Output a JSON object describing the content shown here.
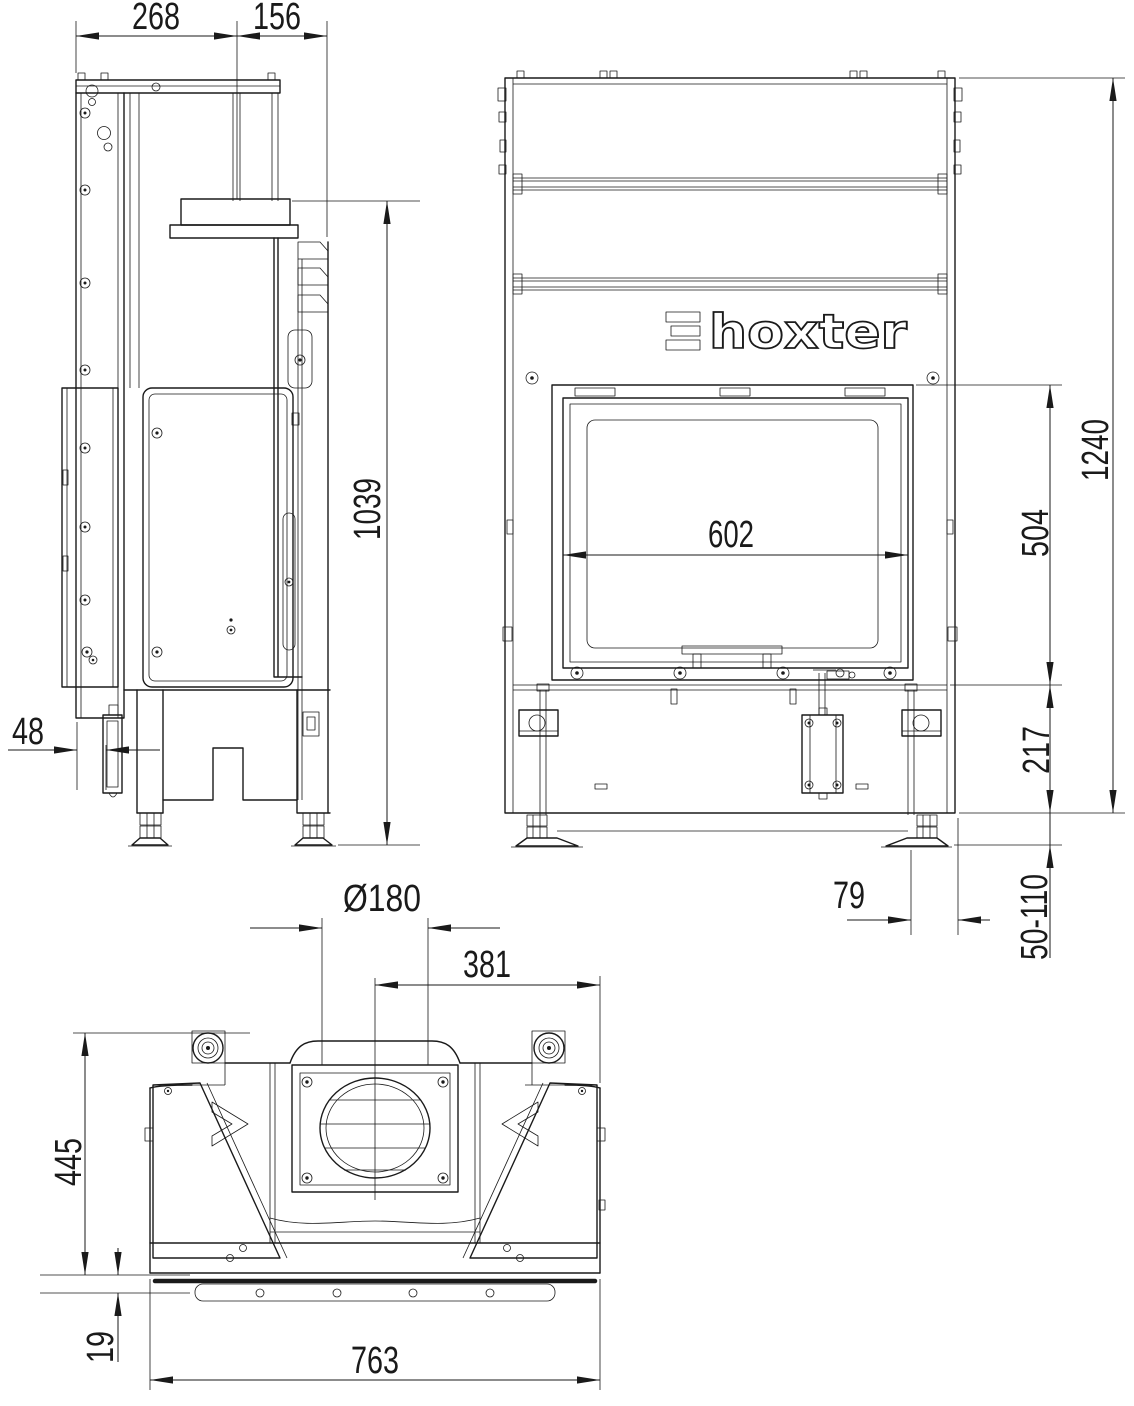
{
  "page": {
    "background": "#ffffff",
    "line_color": "#1a1a1a"
  },
  "logo": {
    "brand": "hoxter",
    "symbol": "triple-bar-icon"
  },
  "dimensions": {
    "side_view": {
      "top_depth": "268",
      "top_front_offset": "156",
      "ledge_to_floor_height": "1039",
      "rear_bracket_depth": "48"
    },
    "front_view": {
      "glass_width": "602",
      "overall_height": "1240",
      "glass_height": "504",
      "base_height": "217",
      "leg_to_edge_offset": "79",
      "foot_adjustment_range": "50-110"
    },
    "top_view": {
      "flue_diameter": "Ø180",
      "flue_center_to_right_edge": "381",
      "overall_depth": "445",
      "base_plate_offset": "19",
      "overall_width": "763"
    }
  }
}
